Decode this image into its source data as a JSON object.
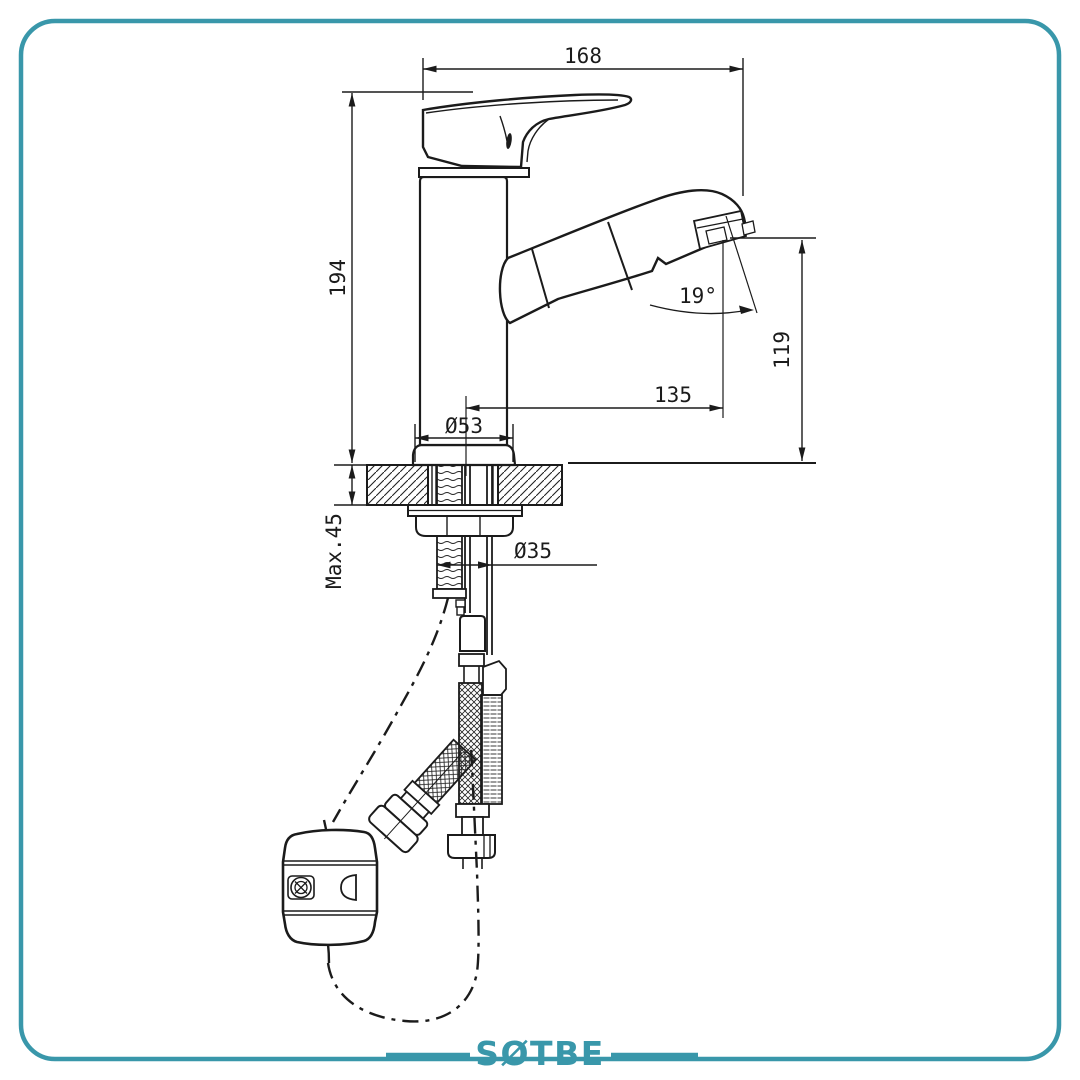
{
  "frame": {
    "border_color": "#3997aa"
  },
  "brand": {
    "name": "SØTBE",
    "color": "#3997aa"
  },
  "drawing": {
    "type": "technical-drawing",
    "subject": "single-lever pull-out basin mixer faucet, side elevation with deck-mount cross-section",
    "line_color": "#1b1b1b",
    "labels": {
      "overall_length": "168",
      "total_height": "194",
      "outlet_height": "119",
      "spout_reach": "135",
      "base_diameter": "Ø53",
      "shank_diameter": "Ø35",
      "max_deck_thickness": "Max.45",
      "spout_angle": "19°"
    }
  }
}
